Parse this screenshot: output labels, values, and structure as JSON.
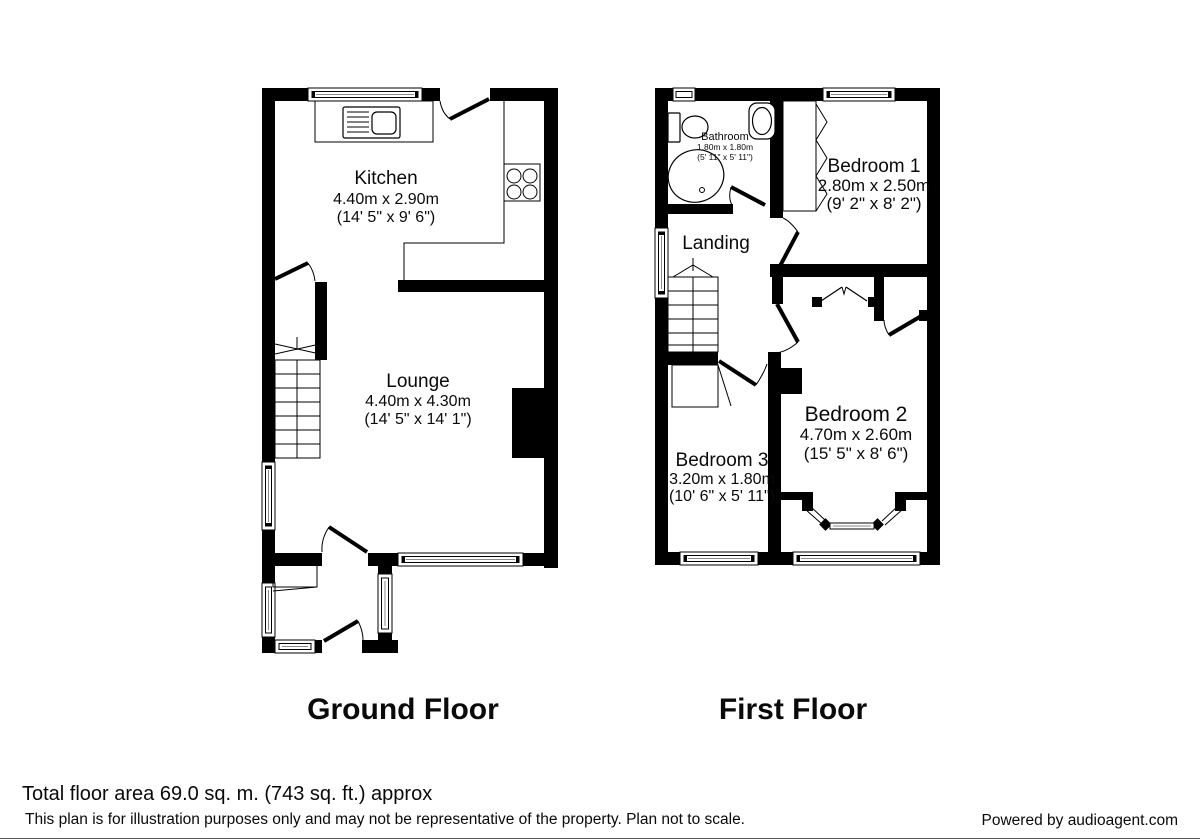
{
  "ground_floor": {
    "title": "Ground Floor",
    "kitchen": {
      "name": "Kitchen",
      "metric": "4.40m x 2.90m",
      "imperial": "(14' 5\" x 9' 6\")"
    },
    "lounge": {
      "name": "Lounge",
      "metric": "4.40m x 4.30m",
      "imperial": "(14' 5\" x 14' 1\")"
    }
  },
  "first_floor": {
    "title": "First Floor",
    "bathroom": {
      "name": "Bathroom",
      "metric": "1.80m x 1.80m",
      "imperial": "(5' 11\" x 5' 11\")"
    },
    "bedroom1": {
      "name": "Bedroom 1",
      "metric": "2.80m x 2.50m",
      "imperial": "(9' 2\" x 8' 2\")"
    },
    "bedroom2": {
      "name": "Bedroom 2",
      "metric": "4.70m x 2.60m",
      "imperial": "(15' 5\" x 8' 6\")"
    },
    "bedroom3": {
      "name": "Bedroom 3",
      "metric": "3.20m x 1.80m",
      "imperial": "(10' 6\" x 5' 11\")"
    },
    "landing": {
      "name": "Landing"
    }
  },
  "footer": {
    "total_area": "Total floor area 69.0 sq. m. (743 sq. ft.) approx",
    "disclaimer": "This plan is for illustration purposes only and may not be representative of the property. Plan not to scale.",
    "credit": "Powered by audioagent.com"
  },
  "colors": {
    "wall": "#000000",
    "background": "#ffffff",
    "window_line": "#8a8a8a"
  }
}
